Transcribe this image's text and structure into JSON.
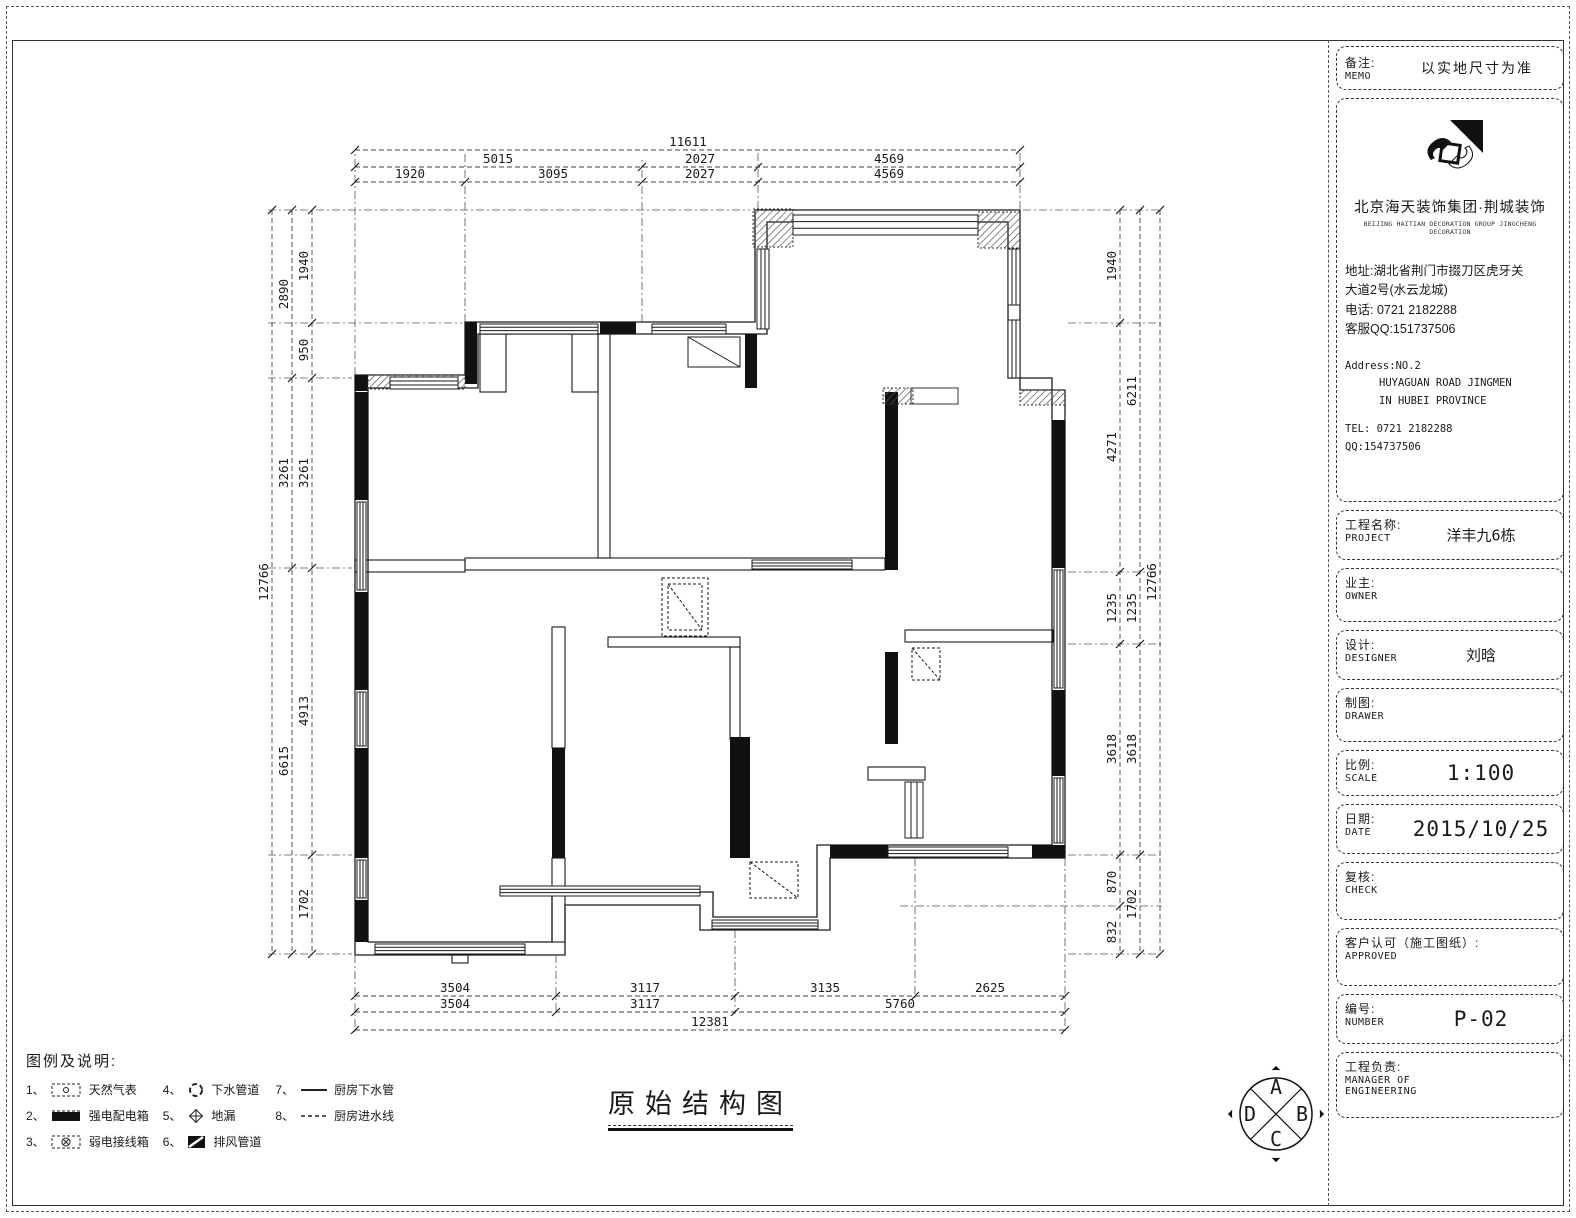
{
  "page": {
    "title": "原始结构图"
  },
  "compass": {
    "letters": {
      "top": "A",
      "right": "B",
      "bottom": "C",
      "left": "D"
    }
  },
  "dims": {
    "top": {
      "total": "11611",
      "row2": [
        "5015",
        "2027",
        "4569"
      ],
      "row3": [
        "1920",
        "3095",
        "2027",
        "4569"
      ]
    },
    "bottom": {
      "row1": [
        "3504",
        "3117",
        "3135",
        "2625"
      ],
      "row2": [
        "3504",
        "3117",
        "5760"
      ],
      "total": "12381"
    },
    "left": {
      "inner": [
        "1940",
        "950",
        "3261",
        "4913",
        "1702"
      ],
      "mid": [
        "2890",
        "3261",
        "6615"
      ],
      "total": "12766"
    },
    "right": {
      "inner": [
        "1940",
        "4271",
        "1235",
        "3618",
        "870",
        "832"
      ],
      "mid": [
        "6211",
        "1235",
        "3618",
        "1702"
      ],
      "total": "12766"
    }
  },
  "legend": {
    "title": "图例及说明:",
    "items": [
      {
        "no": "1、",
        "label": "天然气表"
      },
      {
        "no": "2、",
        "label": "强电配电箱"
      },
      {
        "no": "3、",
        "label": "弱电接线箱"
      },
      {
        "no": "4、",
        "label": "下水管道"
      },
      {
        "no": "5、",
        "label": "地漏"
      },
      {
        "no": "6、",
        "label": "排风管道"
      },
      {
        "no": "7、",
        "label": "厨房下水管"
      },
      {
        "no": "8、",
        "label": "厨房进水线"
      }
    ]
  },
  "titleblock": {
    "memo": {
      "label_cn": "备注:",
      "label_en": "MEMO",
      "value": "以实地尺寸为准"
    },
    "company": {
      "name_cn": "北京海天装饰集团·荆城装饰",
      "name_en": "BEIJING HAITIAN DECORATION GROUP JINGCHENG DECORATION",
      "address_cn1": "地址:湖北省荆门市掇刀区虎牙关",
      "address_cn2": "大道2号(水云龙城)",
      "phone_cn": "电话: 0721 2182288",
      "qq_cn": "客服QQ:151737506",
      "address_en1": "Address:NO.2",
      "address_en2": "HUYAGUAN ROAD JINGMEN",
      "address_en3": "IN HUBEI PROVINCE",
      "tel_en": "TEL: 0721 2182288",
      "qq_en": "QQ:154737506"
    },
    "fields": {
      "project": {
        "label_cn": "工程名称:",
        "label_en": "PROJECT",
        "value": "洋丰九6栋"
      },
      "owner": {
        "label_cn": "业主:",
        "label_en": "OWNER",
        "value": ""
      },
      "designer": {
        "label_cn": "设计:",
        "label_en": "DESIGNER",
        "value": "刘晗"
      },
      "drawer": {
        "label_cn": "制图:",
        "label_en": "DRAWER",
        "value": ""
      },
      "scale": {
        "label_cn": "比例:",
        "label_en": "SCALE",
        "value": "1:100"
      },
      "date": {
        "label_cn": "日期:",
        "label_en": "DATE",
        "value": "2015/10/25"
      },
      "check": {
        "label_cn": "复核:",
        "label_en": "CHECK",
        "value": ""
      },
      "approved": {
        "label_cn": "客户认可（施工图纸）:",
        "label_en": "APPROVED",
        "value": ""
      },
      "number": {
        "label_cn": "编号:",
        "label_en": "NUMBER",
        "value": "P-02"
      },
      "manager": {
        "label_cn": "工程负责:",
        "label_en1": "MANAGER OF",
        "label_en2": "ENGINEERING",
        "value": ""
      }
    }
  }
}
